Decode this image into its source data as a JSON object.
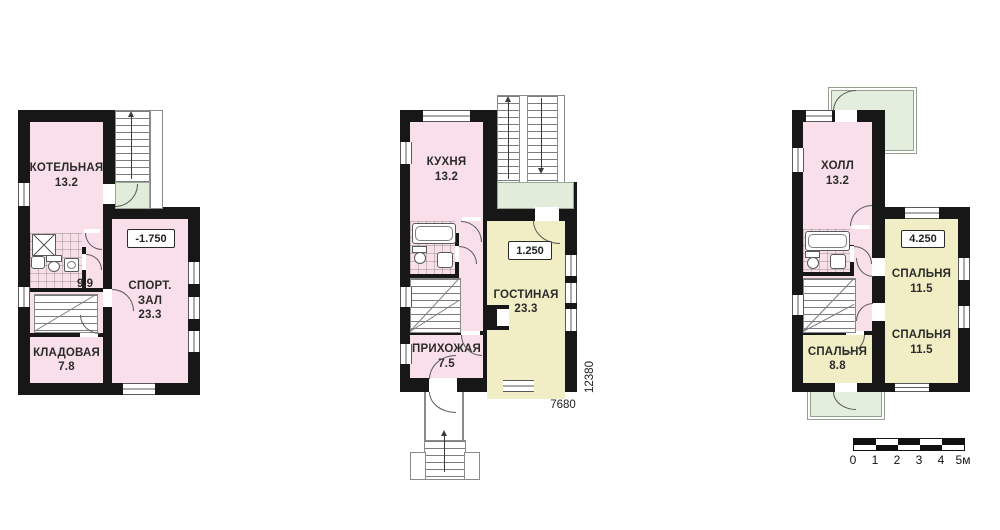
{
  "plans": {
    "basement": {
      "rooms": {
        "boiler": {
          "name": "КОТЕЛЬНАЯ",
          "area": "13.2"
        },
        "corridor": {
          "area": "9.9"
        },
        "gym": {
          "name1": "СПОРТ.",
          "name2": "ЗАЛ",
          "area": "23.3"
        },
        "storage": {
          "name": "КЛАДОВАЯ",
          "area": "7.8"
        }
      },
      "level": "-1.750"
    },
    "first": {
      "rooms": {
        "kitchen": {
          "name": "КУХНЯ",
          "area": "13.2"
        },
        "living": {
          "name": "ГОСТИНАЯ",
          "area": "23.3"
        },
        "hallway": {
          "name": "ПРИХОЖАЯ",
          "area": "7.5"
        }
      },
      "level": "1.250",
      "dims": {
        "width": "7680",
        "height": "12380"
      }
    },
    "second": {
      "rooms": {
        "hall": {
          "name": "ХОЛЛ",
          "area": "13.2"
        },
        "bedroom_top": {
          "name": "СПАЛЬНЯ",
          "area": "11.5"
        },
        "bedroom_bottom": {
          "name": "СПАЛЬНЯ",
          "area": "11.5"
        },
        "bedroom_small": {
          "name": "СПАЛЬНЯ",
          "area": "8.8"
        }
      },
      "level": "4.250"
    }
  },
  "scale_bar": {
    "labels": [
      "0",
      "1",
      "2",
      "3",
      "4",
      "5м"
    ]
  },
  "colors": {
    "room_pink": "#f8dfe9",
    "room_yellow": "#f1eec5",
    "landing_green": "#e1ecda",
    "wall_black": "#171717"
  }
}
